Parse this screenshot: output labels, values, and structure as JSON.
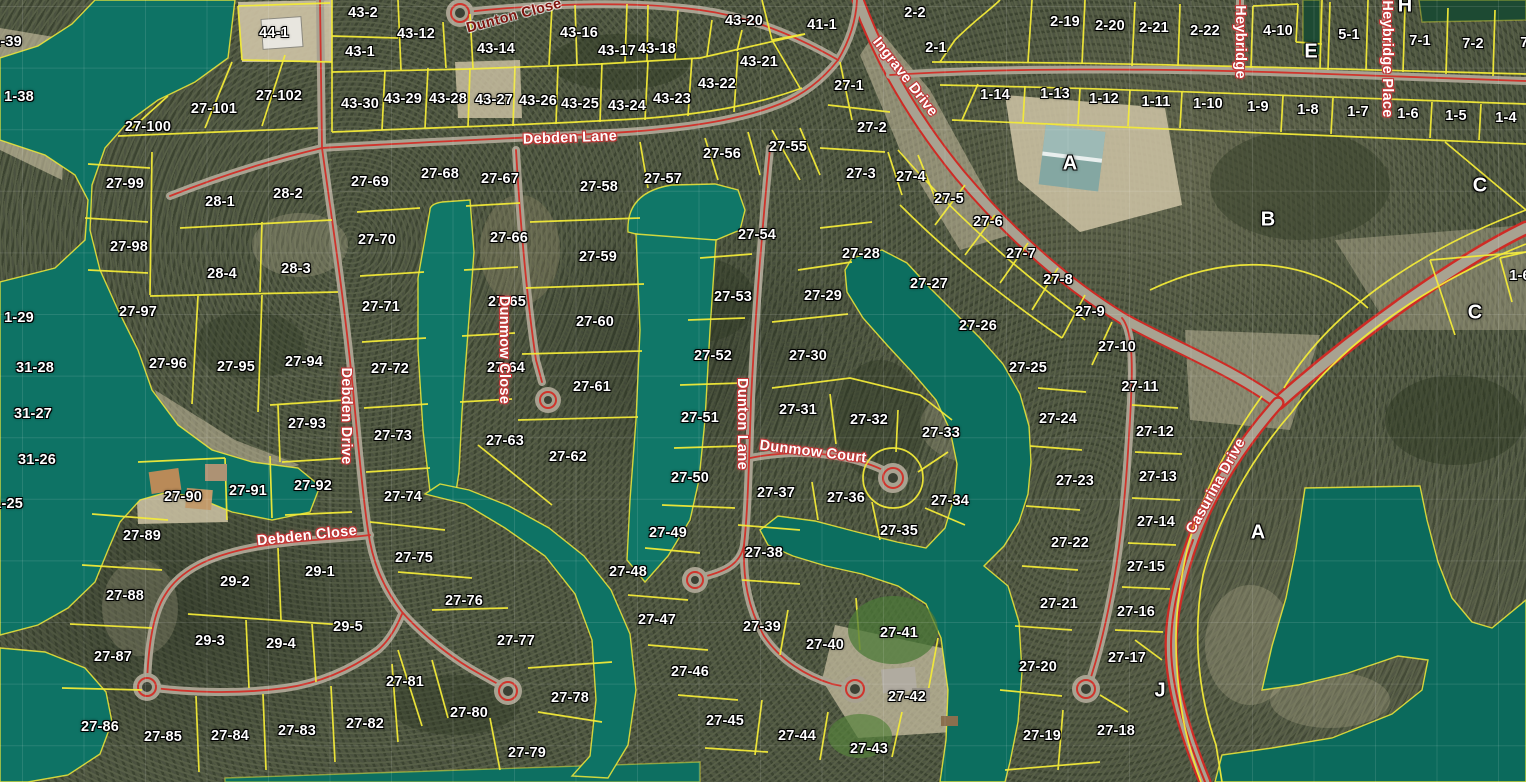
{
  "map": {
    "colors": {
      "water": "#0e7365",
      "water_deep": "#0b6a5c",
      "parcel_line": "#f2ea38",
      "road_fill": "#a8a291",
      "road_line": "#d0342c",
      "sand": "#cfc4a6",
      "label_text": "#ffffff",
      "street_text": "#ffffff",
      "street_halo": "#c03636"
    },
    "parcel_labels": [
      {
        "text": "1-39",
        "x": 7,
        "y": 42
      },
      {
        "text": "1-38",
        "x": 19,
        "y": 97
      },
      {
        "text": "1-29",
        "x": 19,
        "y": 318
      },
      {
        "text": "31-28",
        "x": 35,
        "y": 368
      },
      {
        "text": "31-27",
        "x": 33,
        "y": 414
      },
      {
        "text": "31-26",
        "x": 37,
        "y": 460
      },
      {
        "text": "31-25",
        "x": 4,
        "y": 504
      },
      {
        "text": "44-1",
        "x": 274,
        "y": 33
      },
      {
        "text": "43-2",
        "x": 363,
        "y": 13
      },
      {
        "text": "43-1",
        "x": 360,
        "y": 52
      },
      {
        "text": "43-12",
        "x": 416,
        "y": 34
      },
      {
        "text": "43-14",
        "x": 496,
        "y": 49
      },
      {
        "text": "43-16",
        "x": 579,
        "y": 33
      },
      {
        "text": "43-17",
        "x": 617,
        "y": 51
      },
      {
        "text": "43-18",
        "x": 657,
        "y": 49
      },
      {
        "text": "43-20",
        "x": 744,
        "y": 21
      },
      {
        "text": "43-21",
        "x": 759,
        "y": 62
      },
      {
        "text": "43-22",
        "x": 717,
        "y": 84
      },
      {
        "text": "43-23",
        "x": 672,
        "y": 99
      },
      {
        "text": "43-24",
        "x": 627,
        "y": 106
      },
      {
        "text": "43-25",
        "x": 580,
        "y": 104
      },
      {
        "text": "43-26",
        "x": 538,
        "y": 101
      },
      {
        "text": "43-27",
        "x": 494,
        "y": 100
      },
      {
        "text": "43-28",
        "x": 448,
        "y": 99
      },
      {
        "text": "43-29",
        "x": 403,
        "y": 99
      },
      {
        "text": "43-30",
        "x": 360,
        "y": 104
      },
      {
        "text": "27-102",
        "x": 279,
        "y": 96
      },
      {
        "text": "27-101",
        "x": 214,
        "y": 109
      },
      {
        "text": "27-100",
        "x": 148,
        "y": 127
      },
      {
        "text": "27-99",
        "x": 125,
        "y": 184
      },
      {
        "text": "27-98",
        "x": 129,
        "y": 247
      },
      {
        "text": "27-97",
        "x": 138,
        "y": 312
      },
      {
        "text": "27-96",
        "x": 168,
        "y": 364
      },
      {
        "text": "27-95",
        "x": 236,
        "y": 367
      },
      {
        "text": "27-94",
        "x": 304,
        "y": 362
      },
      {
        "text": "27-93",
        "x": 307,
        "y": 424
      },
      {
        "text": "27-92",
        "x": 313,
        "y": 486
      },
      {
        "text": "27-91",
        "x": 248,
        "y": 491
      },
      {
        "text": "27-90",
        "x": 183,
        "y": 497
      },
      {
        "text": "27-89",
        "x": 142,
        "y": 536
      },
      {
        "text": "27-88",
        "x": 125,
        "y": 596
      },
      {
        "text": "27-87",
        "x": 113,
        "y": 657
      },
      {
        "text": "27-86",
        "x": 100,
        "y": 727
      },
      {
        "text": "27-85",
        "x": 163,
        "y": 737
      },
      {
        "text": "27-84",
        "x": 230,
        "y": 736
      },
      {
        "text": "27-83",
        "x": 297,
        "y": 731
      },
      {
        "text": "27-82",
        "x": 365,
        "y": 724
      },
      {
        "text": "28-1",
        "x": 220,
        "y": 202
      },
      {
        "text": "28-2",
        "x": 288,
        "y": 194
      },
      {
        "text": "28-4",
        "x": 222,
        "y": 274
      },
      {
        "text": "28-3",
        "x": 296,
        "y": 269
      },
      {
        "text": "29-2",
        "x": 235,
        "y": 582
      },
      {
        "text": "29-1",
        "x": 320,
        "y": 572
      },
      {
        "text": "29-3",
        "x": 210,
        "y": 641
      },
      {
        "text": "29-4",
        "x": 281,
        "y": 644
      },
      {
        "text": "29-5",
        "x": 348,
        "y": 627
      },
      {
        "text": "27-69",
        "x": 370,
        "y": 182
      },
      {
        "text": "27-70",
        "x": 377,
        "y": 240
      },
      {
        "text": "27-71",
        "x": 381,
        "y": 307
      },
      {
        "text": "27-72",
        "x": 390,
        "y": 369
      },
      {
        "text": "27-73",
        "x": 393,
        "y": 436
      },
      {
        "text": "27-74",
        "x": 403,
        "y": 497
      },
      {
        "text": "27-75",
        "x": 414,
        "y": 558
      },
      {
        "text": "27-76",
        "x": 464,
        "y": 601
      },
      {
        "text": "27-77",
        "x": 516,
        "y": 641
      },
      {
        "text": "27-81",
        "x": 405,
        "y": 682
      },
      {
        "text": "27-80",
        "x": 469,
        "y": 713
      },
      {
        "text": "27-78",
        "x": 570,
        "y": 698
      },
      {
        "text": "27-79",
        "x": 527,
        "y": 753
      },
      {
        "text": "27-68",
        "x": 440,
        "y": 174
      },
      {
        "text": "27-67",
        "x": 500,
        "y": 179
      },
      {
        "text": "27-66",
        "x": 509,
        "y": 238
      },
      {
        "text": "27-65",
        "x": 507,
        "y": 302
      },
      {
        "text": "27-64",
        "x": 506,
        "y": 368
      },
      {
        "text": "27-63",
        "x": 505,
        "y": 441
      },
      {
        "text": "27-62",
        "x": 568,
        "y": 457
      },
      {
        "text": "27-58",
        "x": 599,
        "y": 187
      },
      {
        "text": "27-59",
        "x": 598,
        "y": 257
      },
      {
        "text": "27-60",
        "x": 595,
        "y": 322
      },
      {
        "text": "27-61",
        "x": 592,
        "y": 387
      },
      {
        "text": "27-57",
        "x": 663,
        "y": 179
      },
      {
        "text": "27-56",
        "x": 722,
        "y": 154
      },
      {
        "text": "27-55",
        "x": 788,
        "y": 147
      },
      {
        "text": "27-54",
        "x": 757,
        "y": 235
      },
      {
        "text": "27-53",
        "x": 733,
        "y": 297
      },
      {
        "text": "27-52",
        "x": 713,
        "y": 356
      },
      {
        "text": "27-51",
        "x": 700,
        "y": 418
      },
      {
        "text": "27-50",
        "x": 690,
        "y": 478
      },
      {
        "text": "27-49",
        "x": 668,
        "y": 533
      },
      {
        "text": "27-48",
        "x": 628,
        "y": 572
      },
      {
        "text": "27-47",
        "x": 657,
        "y": 620
      },
      {
        "text": "27-46",
        "x": 690,
        "y": 672
      },
      {
        "text": "27-45",
        "x": 725,
        "y": 721
      },
      {
        "text": "27-44",
        "x": 797,
        "y": 736
      },
      {
        "text": "27-43",
        "x": 869,
        "y": 749
      },
      {
        "text": "27-42",
        "x": 907,
        "y": 697
      },
      {
        "text": "27-41",
        "x": 899,
        "y": 633
      },
      {
        "text": "27-40",
        "x": 825,
        "y": 645
      },
      {
        "text": "27-39",
        "x": 762,
        "y": 627
      },
      {
        "text": "27-38",
        "x": 764,
        "y": 553
      },
      {
        "text": "27-37",
        "x": 776,
        "y": 493
      },
      {
        "text": "27-36",
        "x": 846,
        "y": 498
      },
      {
        "text": "27-35",
        "x": 899,
        "y": 531
      },
      {
        "text": "27-34",
        "x": 950,
        "y": 501
      },
      {
        "text": "27-33",
        "x": 941,
        "y": 433
      },
      {
        "text": "27-32",
        "x": 869,
        "y": 420
      },
      {
        "text": "27-31",
        "x": 798,
        "y": 410
      },
      {
        "text": "27-30",
        "x": 808,
        "y": 356
      },
      {
        "text": "27-29",
        "x": 823,
        "y": 296
      },
      {
        "text": "27-28",
        "x": 861,
        "y": 254
      },
      {
        "text": "27-27",
        "x": 929,
        "y": 284
      },
      {
        "text": "27-26",
        "x": 978,
        "y": 326
      },
      {
        "text": "27-25",
        "x": 1028,
        "y": 368
      },
      {
        "text": "27-24",
        "x": 1058,
        "y": 419
      },
      {
        "text": "27-23",
        "x": 1075,
        "y": 481
      },
      {
        "text": "27-22",
        "x": 1070,
        "y": 543
      },
      {
        "text": "27-21",
        "x": 1059,
        "y": 604
      },
      {
        "text": "27-20",
        "x": 1038,
        "y": 667
      },
      {
        "text": "27-19",
        "x": 1042,
        "y": 736
      },
      {
        "text": "27-18",
        "x": 1116,
        "y": 731
      },
      {
        "text": "27-17",
        "x": 1127,
        "y": 658
      },
      {
        "text": "27-16",
        "x": 1136,
        "y": 612
      },
      {
        "text": "27-15",
        "x": 1146,
        "y": 567
      },
      {
        "text": "27-14",
        "x": 1156,
        "y": 522
      },
      {
        "text": "27-13",
        "x": 1158,
        "y": 477
      },
      {
        "text": "27-12",
        "x": 1155,
        "y": 432
      },
      {
        "text": "27-11",
        "x": 1140,
        "y": 387
      },
      {
        "text": "27-10",
        "x": 1117,
        "y": 347
      },
      {
        "text": "27-9",
        "x": 1090,
        "y": 312
      },
      {
        "text": "27-8",
        "x": 1058,
        "y": 280
      },
      {
        "text": "27-7",
        "x": 1021,
        "y": 254
      },
      {
        "text": "27-6",
        "x": 988,
        "y": 222
      },
      {
        "text": "27-5",
        "x": 949,
        "y": 199
      },
      {
        "text": "27-4",
        "x": 911,
        "y": 177
      },
      {
        "text": "27-3",
        "x": 861,
        "y": 174
      },
      {
        "text": "27-2",
        "x": 872,
        "y": 128
      },
      {
        "text": "27-1",
        "x": 849,
        "y": 86
      },
      {
        "text": "41-1",
        "x": 822,
        "y": 25
      },
      {
        "text": "2-2",
        "x": 915,
        "y": 13
      },
      {
        "text": "2-1",
        "x": 936,
        "y": 48
      },
      {
        "text": "2-19",
        "x": 1065,
        "y": 22
      },
      {
        "text": "2-20",
        "x": 1110,
        "y": 26
      },
      {
        "text": "2-21",
        "x": 1154,
        "y": 28
      },
      {
        "text": "2-22",
        "x": 1205,
        "y": 31
      },
      {
        "text": "4-10",
        "x": 1278,
        "y": 31
      },
      {
        "text": "5-1",
        "x": 1349,
        "y": 35
      },
      {
        "text": "7-1",
        "x": 1420,
        "y": 41
      },
      {
        "text": "7-2",
        "x": 1473,
        "y": 44
      },
      {
        "text": "7-3",
        "x": 1531,
        "y": 43
      },
      {
        "text": "1-14",
        "x": 995,
        "y": 95
      },
      {
        "text": "1-13",
        "x": 1055,
        "y": 94
      },
      {
        "text": "1-12",
        "x": 1104,
        "y": 99
      },
      {
        "text": "1-11",
        "x": 1156,
        "y": 102
      },
      {
        "text": "1-10",
        "x": 1208,
        "y": 104
      },
      {
        "text": "1-9",
        "x": 1258,
        "y": 107
      },
      {
        "text": "1-8",
        "x": 1308,
        "y": 110
      },
      {
        "text": "1-7",
        "x": 1358,
        "y": 112
      },
      {
        "text": "1-6",
        "x": 1408,
        "y": 114
      },
      {
        "text": "1-5",
        "x": 1456,
        "y": 116
      },
      {
        "text": "1-4",
        "x": 1506,
        "y": 118
      },
      {
        "text": "1-6",
        "x": 1520,
        "y": 276
      }
    ],
    "section_labels": [
      {
        "text": "A",
        "x": 1070,
        "y": 164
      },
      {
        "text": "B",
        "x": 1268,
        "y": 220
      },
      {
        "text": "C",
        "x": 1480,
        "y": 186
      },
      {
        "text": "C",
        "x": 1475,
        "y": 313
      },
      {
        "text": "A",
        "x": 1258,
        "y": 533
      },
      {
        "text": "J",
        "x": 1160,
        "y": 691
      },
      {
        "text": "E",
        "x": 1311,
        "y": 52
      },
      {
        "text": "H",
        "x": 1405,
        "y": 6
      }
    ],
    "street_labels": [
      {
        "text": "Debden Lane",
        "x": 570,
        "y": 138,
        "rot": -2
      },
      {
        "text": "Dunton Close",
        "x": 514,
        "y": 16,
        "rot": -15,
        "cls": "dark"
      },
      {
        "text": "Ingrave Drive",
        "x": 905,
        "y": 77,
        "rot": 52
      },
      {
        "text": "Heybridge",
        "x": 1240,
        "y": 42,
        "rot": 90
      },
      {
        "text": "Heybridge Place",
        "x": 1387,
        "y": 59,
        "rot": 90
      },
      {
        "text": "Debden Drive",
        "x": 346,
        "y": 416,
        "rot": 90
      },
      {
        "text": "Dunmow Close",
        "x": 504,
        "y": 350,
        "rot": 90
      },
      {
        "text": "Dunton Lane",
        "x": 742,
        "y": 424,
        "rot": 90
      },
      {
        "text": "Dunmow Court",
        "x": 813,
        "y": 452,
        "rot": 7
      },
      {
        "text": "Debden Close",
        "x": 307,
        "y": 536,
        "rot": -6
      },
      {
        "text": "Casurina Drive",
        "x": 1216,
        "y": 486,
        "rot": -61
      }
    ]
  }
}
